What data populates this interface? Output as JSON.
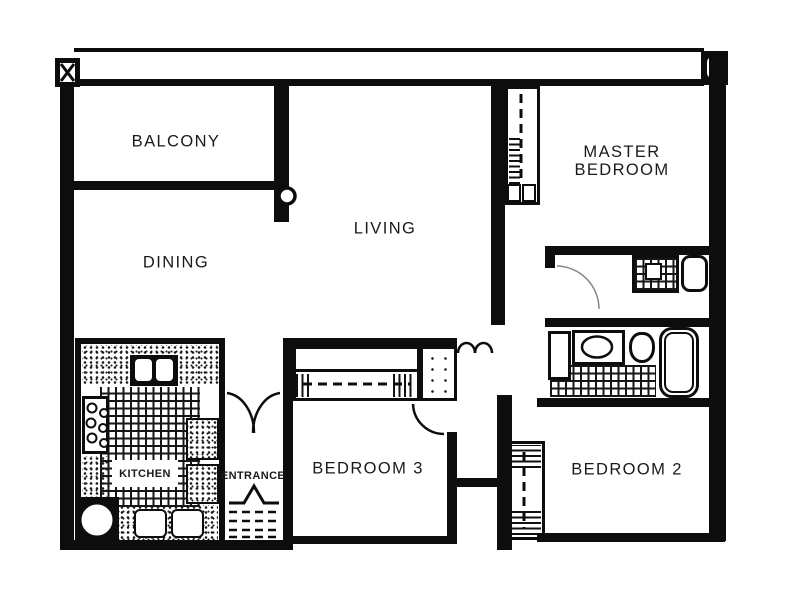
{
  "title": "3-bedroom apartment floor plan",
  "colors": {
    "wall": "#0d0d0d",
    "background": "#ffffff",
    "label": "#1a1a1a",
    "faint_line": "#888888"
  },
  "rooms": {
    "balcony": {
      "label": "BALCONY"
    },
    "dining": {
      "label": "DINING"
    },
    "living": {
      "label": "LIVING"
    },
    "master_bedroom": {
      "label_line1": "MASTER",
      "label_line2": "BEDROOM"
    },
    "bedroom3": {
      "label": "BEDROOM 3"
    },
    "bedroom2": {
      "label": "BEDROOM 2"
    },
    "kitchen": {
      "label": "KITCHEN"
    },
    "entrance": {
      "label": "ENTRANCE"
    }
  }
}
